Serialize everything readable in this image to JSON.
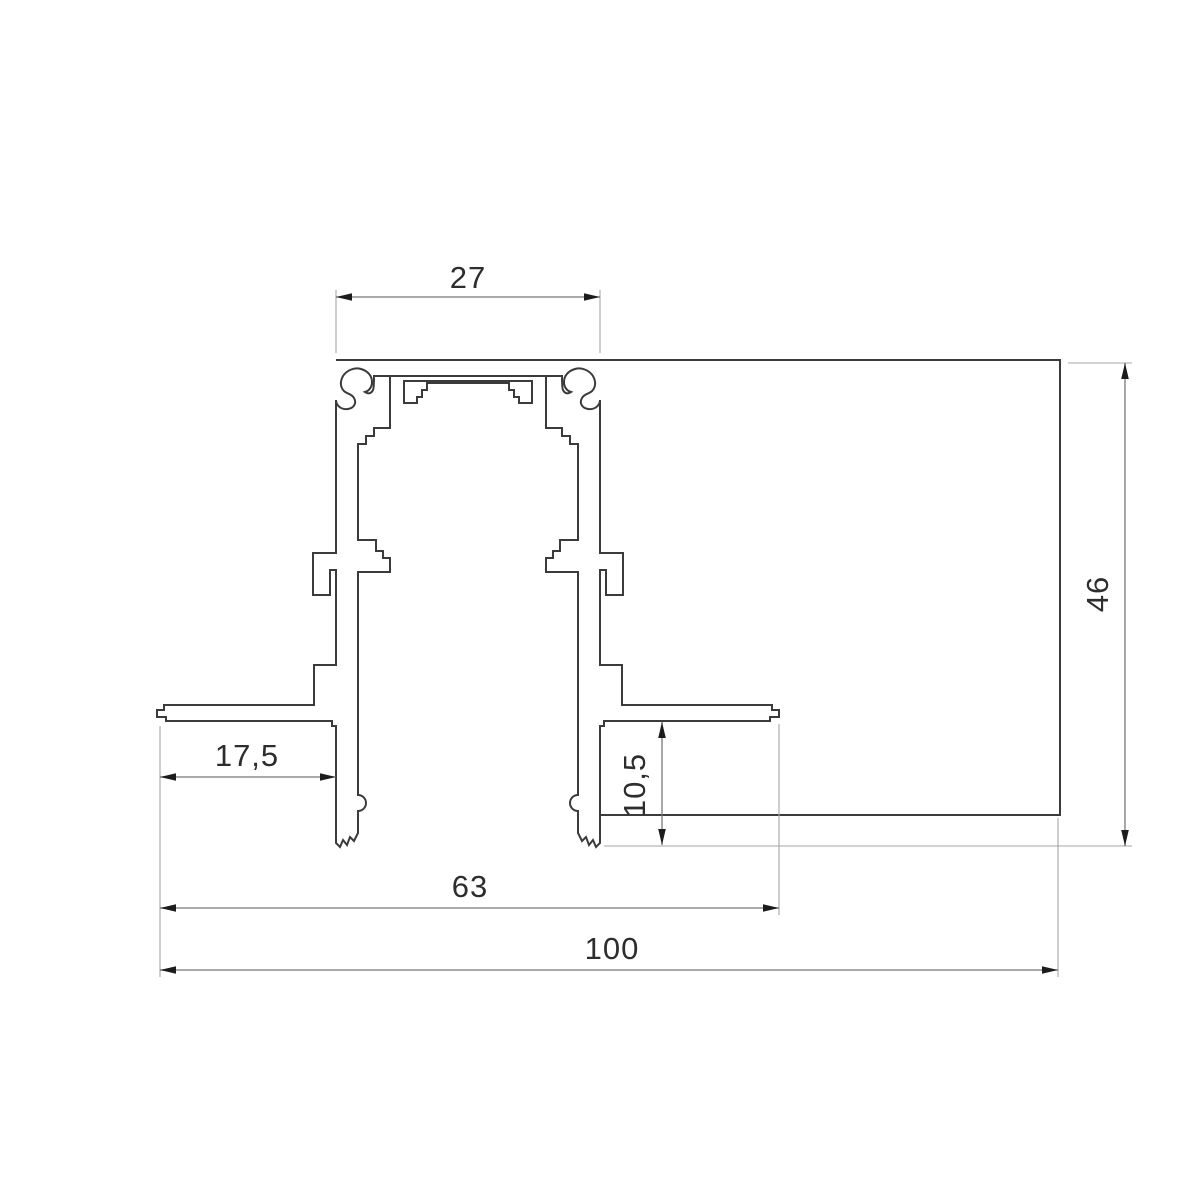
{
  "drawing": {
    "kind": "technical-profile-cross-section",
    "dimensions": {
      "top_width": {
        "label": "27"
      },
      "overall_height": {
        "label": "46"
      },
      "flange_offset": {
        "label": "17,5"
      },
      "recess_depth": {
        "label": "10,5"
      },
      "legs_span": {
        "label": "63"
      },
      "overall_width": {
        "label": "100"
      }
    },
    "colors": {
      "background": "#ffffff",
      "outline": "#3b3b3b",
      "dimension_line": "#787878",
      "extension_line": "#a6a6a6",
      "arrow": "#1c1c1c",
      "text": "#2d2d2d"
    }
  }
}
